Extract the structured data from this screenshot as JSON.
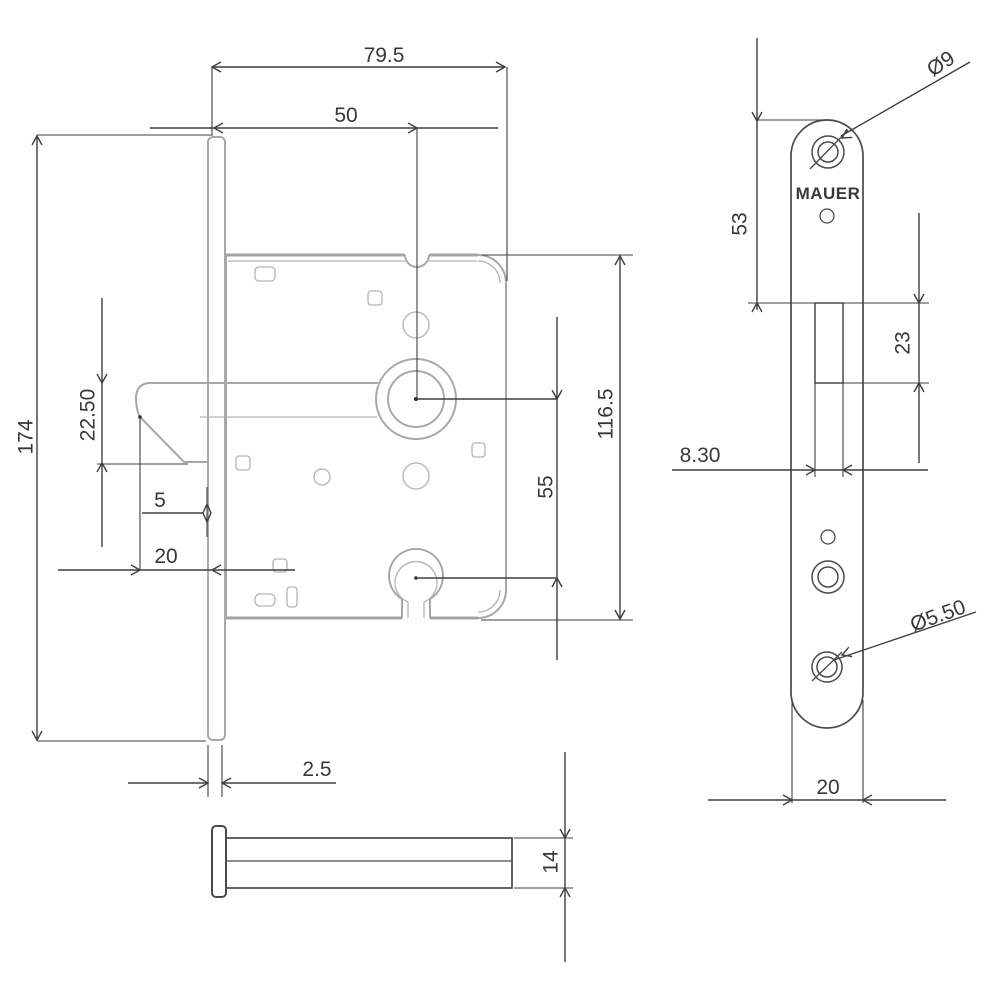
{
  "drawing": {
    "main_view": {
      "total_width": "79.5",
      "backset": "50",
      "total_height": "174",
      "latch_height": "22.50",
      "latch_offset": "5",
      "front_depth": "20",
      "case_height": "116.5",
      "spindle_to_key": "55",
      "faceplate_thickness": "2.5"
    },
    "faceplate_view": {
      "brand": "MAUER",
      "top_hole_diameter": "Ø9",
      "top_to_latch_cutout": "53",
      "latch_cutout_height": "23",
      "latch_cutout_width": "8.30",
      "bottom_hole_diameter": "Ø5.50",
      "plate_width": "20"
    },
    "side_view": {
      "case_thickness": "14"
    }
  }
}
